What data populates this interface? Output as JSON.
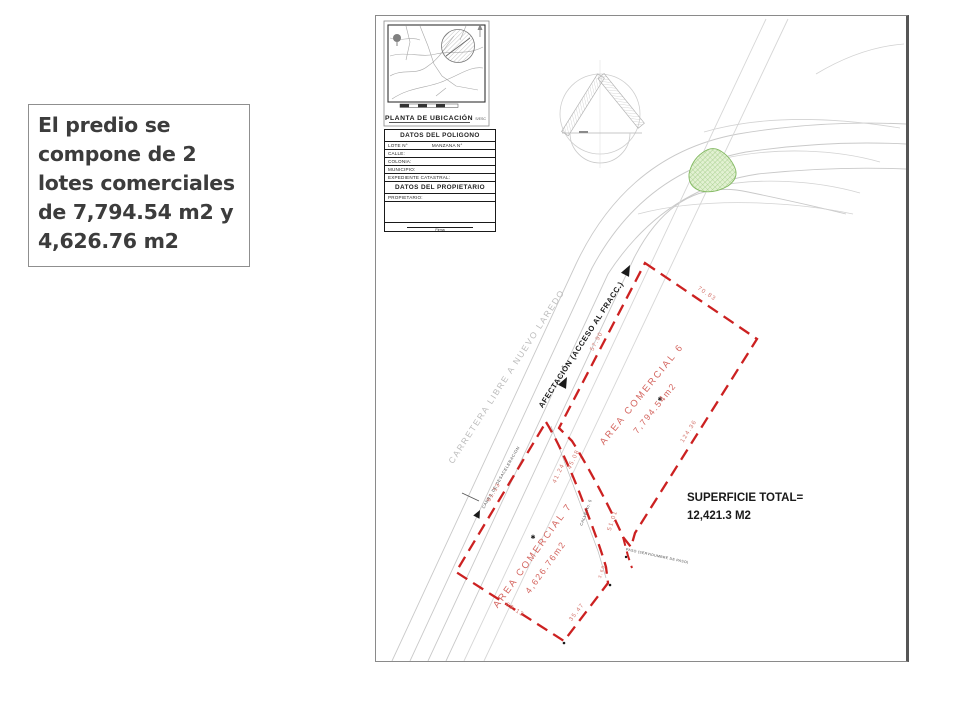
{
  "caption": {
    "text": "El predio se compone de 2 lotes comerciales de 7,794.54 m2 y 4,626.76 m2"
  },
  "drawing": {
    "location_map": {
      "title": "PLANTA DE UBICACIÓN",
      "scale": "S/ESC"
    },
    "table": {
      "polygon_title": "DATOS DEL POLIGONO",
      "lot_label": "LOTE N°",
      "block_label": "MANZANA N°",
      "rows": [
        "CALLE:",
        "COLONIA:",
        "MUNICIPIO:",
        "EXPEDIENTE CATASTRAL:"
      ],
      "owner_title": "DATOS DEL PROPIETARIO",
      "owner_label": "PROPIETARIO:",
      "signature_label": "Firma"
    },
    "roads": {
      "highway": "CARRETERA  LIBRE  A  NUEVO  LAREDO",
      "access": "AFECTACIÓN  (ACCESO AL FRACC.)",
      "lane": "CARRIL DE DESACELERACION",
      "street": "CALLE No. 5",
      "easement": "PASO (SERVIDUMBRE DE PASO)"
    },
    "lots": {
      "lot6": {
        "name": "AREA  COMERCIAL  6",
        "area": "7,794.54m2"
      },
      "lot7": {
        "name": "AREA  COMERCIAL  7",
        "area": "4,626.76m2"
      }
    },
    "total": {
      "label": "SUPERFICIE TOTAL=",
      "value": "12,421.3 M2"
    },
    "dims": {
      "lot6_ne": "70.83",
      "lot6_se": "124.36",
      "lot6_road": "57.90",
      "corr_a": "45.08",
      "corr_b": "41.24",
      "corr_c": "51.01",
      "corr_d": "3.69",
      "lot7_w": "61.13",
      "lot7_sw": "69.13",
      "lot7_se": "35.47"
    },
    "colors": {
      "boundary_red": "#cc2121",
      "area_text_red": "#d4655f",
      "road_gray": "#c9c9c9",
      "green_fill": "#e2f1d2",
      "green_edge": "#83b962"
    }
  }
}
